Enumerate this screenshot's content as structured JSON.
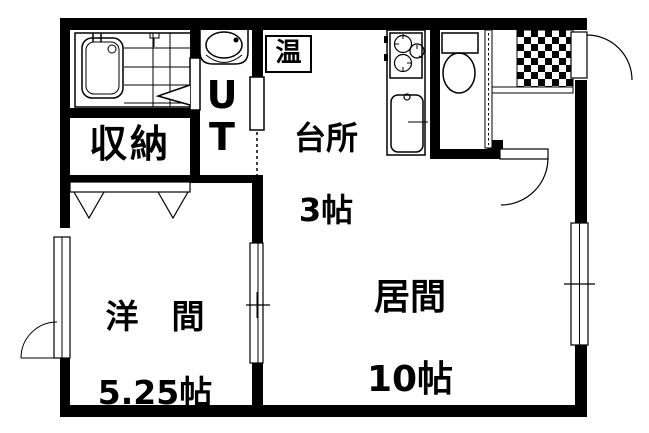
{
  "floorplan": {
    "colors": {
      "wall": "#000000",
      "floor": "#ffffff",
      "line": "#000000"
    },
    "rooms": {
      "kitchen": {
        "name": "台所",
        "size": "3帖"
      },
      "living": {
        "name": "居間",
        "size": "10帖"
      },
      "western": {
        "name": "洋　間",
        "size": "5.25帖"
      },
      "storage": {
        "name": "収納"
      },
      "utility": {
        "name": "UT"
      },
      "water_heater": {
        "name": "温"
      }
    }
  }
}
